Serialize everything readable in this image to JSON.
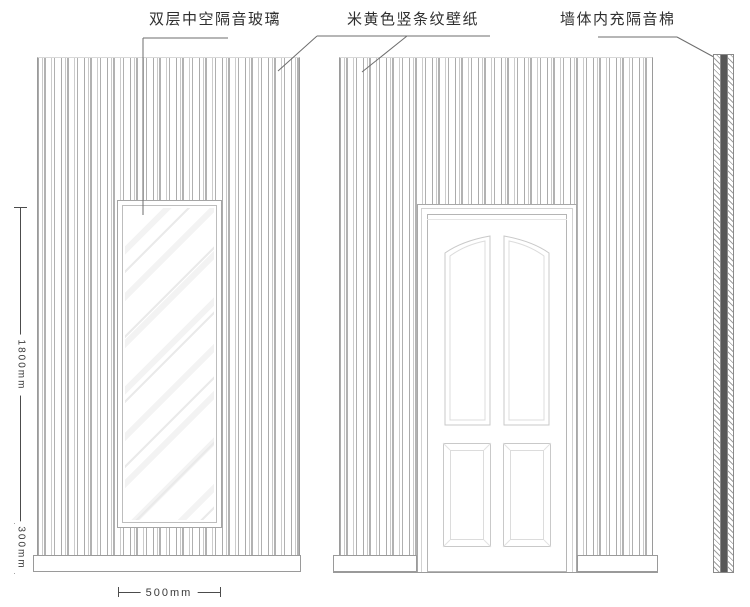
{
  "title": "soundproof-wall-elevation-drawing",
  "annotations": {
    "glass": "双层中空隔音玻璃",
    "wallpaper": "米黄色竖条纹壁纸",
    "insulation": "墙体内充隔音棉"
  },
  "dimensions": {
    "total_height": "1800mm",
    "base_height": "300mm",
    "window_width": "500mm"
  },
  "colors": {
    "leader_line": "#6e6e6e",
    "panel_stripe": "#b2b2b2",
    "drawing_line": "#9a9a9a",
    "door_panel_line": "#cccccc",
    "insulation_fill": "#585858",
    "dimension_line": "#4c4c4c",
    "label_text": "#2f2f2f"
  }
}
